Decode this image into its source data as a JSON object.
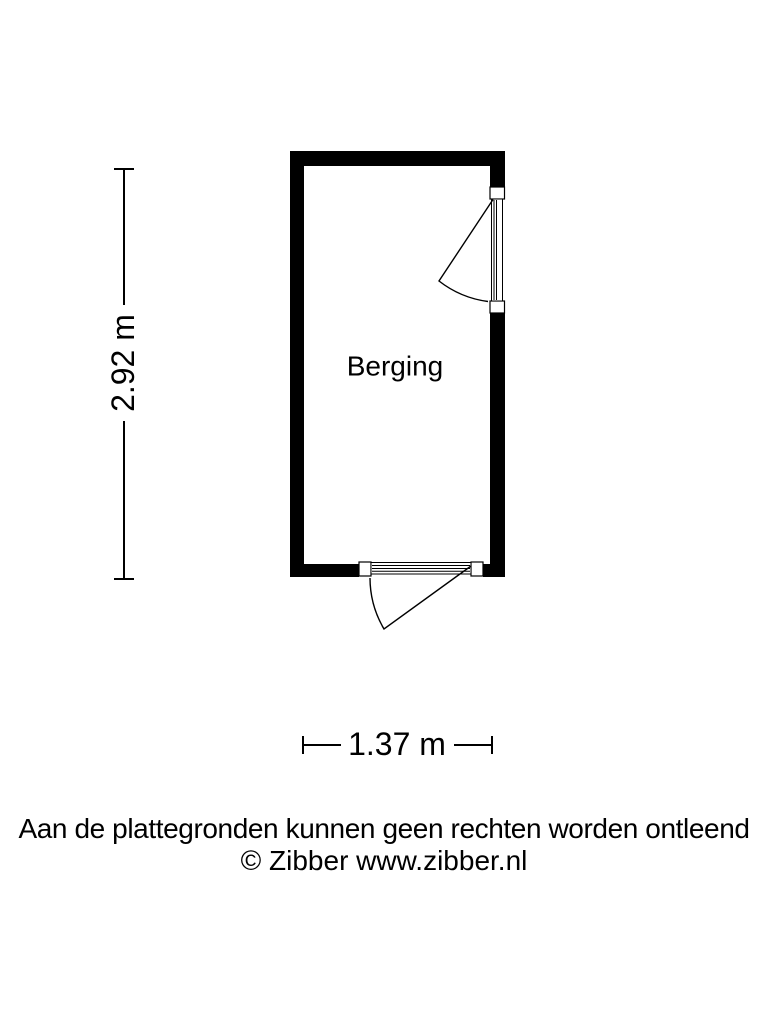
{
  "floorplan": {
    "room": {
      "label": "Berging"
    },
    "dimensions": {
      "height_label": "2.92 m",
      "width_label": "1.37 m"
    }
  },
  "footer": {
    "disclaimer": "Aan de plattegronden kunnen geen rechten worden ontleend",
    "copyright": "© Zibber www.zibber.nl"
  },
  "colors": {
    "background": "#ffffff",
    "wall": "#000000",
    "line": "#000000",
    "text": "#000000"
  }
}
